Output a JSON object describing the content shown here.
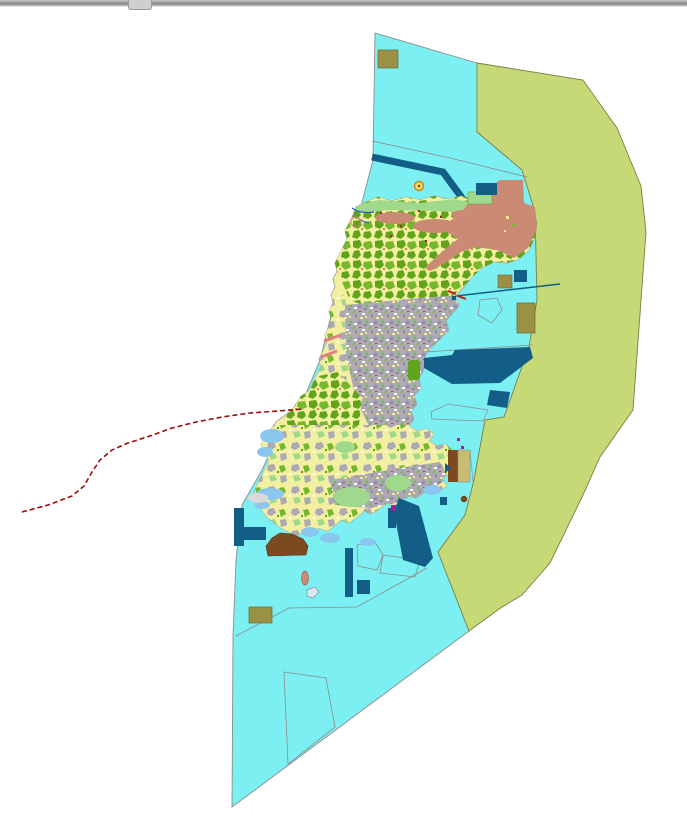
{
  "window": {
    "top_bar": {
      "kind": "window-top-edge"
    },
    "splitter_handle": {
      "kind": "drag-handle"
    }
  },
  "map": {
    "type": "land-use-planning-map",
    "description": "City-planning / land-use map of an elongated island: detailed parcel mosaic on land, cyan sea planning zone, olive-green outer district band to the east, port structures, and a dashed red ferry route running to the southwest.",
    "palette": {
      "background": "#FFFFFF",
      "sea": "#7CEFF2",
      "band_green": "#C5D977",
      "island_yellow": "#F2EFA0",
      "forest_green": "#5FA41B",
      "forest_green2": "#74B82E",
      "light_green": "#9FD98C",
      "urban_gray": "#ACA9B5",
      "urban_dark": "#8F8C9C",
      "salmon": "#CB8A74",
      "dark_teal": "#135E86",
      "olive": "#9A9147",
      "brown": "#7B4A20",
      "red_line": "#9E0B0B",
      "pink": "#E57D84",
      "shore_blue": "#8AC6EF",
      "stream_blue": "#2B5FD0",
      "magenta": "#B0189A",
      "outline": "#8C8C8C",
      "bar_gray": "#9A9A9A"
    },
    "legend_semantics": [
      {
        "feature": "sea-planning-zone",
        "color_key": "sea"
      },
      {
        "feature": "outer-district-band",
        "color_key": "band_green"
      },
      {
        "feature": "island-farmland-mosaic",
        "color_key": "island_yellow"
      },
      {
        "feature": "forest-parcels",
        "color_key": "forest_green"
      },
      {
        "feature": "urban-built-up-area",
        "color_key": "urban_gray"
      },
      {
        "feature": "residential-district",
        "color_key": "salmon"
      },
      {
        "feature": "port-harbor-structures",
        "color_key": "dark_teal"
      },
      {
        "feature": "industrial-plots",
        "color_key": "olive"
      },
      {
        "feature": "reclaimed-land",
        "color_key": "brown"
      },
      {
        "feature": "ferry-route-dashed-line",
        "color_key": "red_line"
      },
      {
        "feature": "shallow-reef-water",
        "color_key": "shore_blue"
      }
    ]
  }
}
